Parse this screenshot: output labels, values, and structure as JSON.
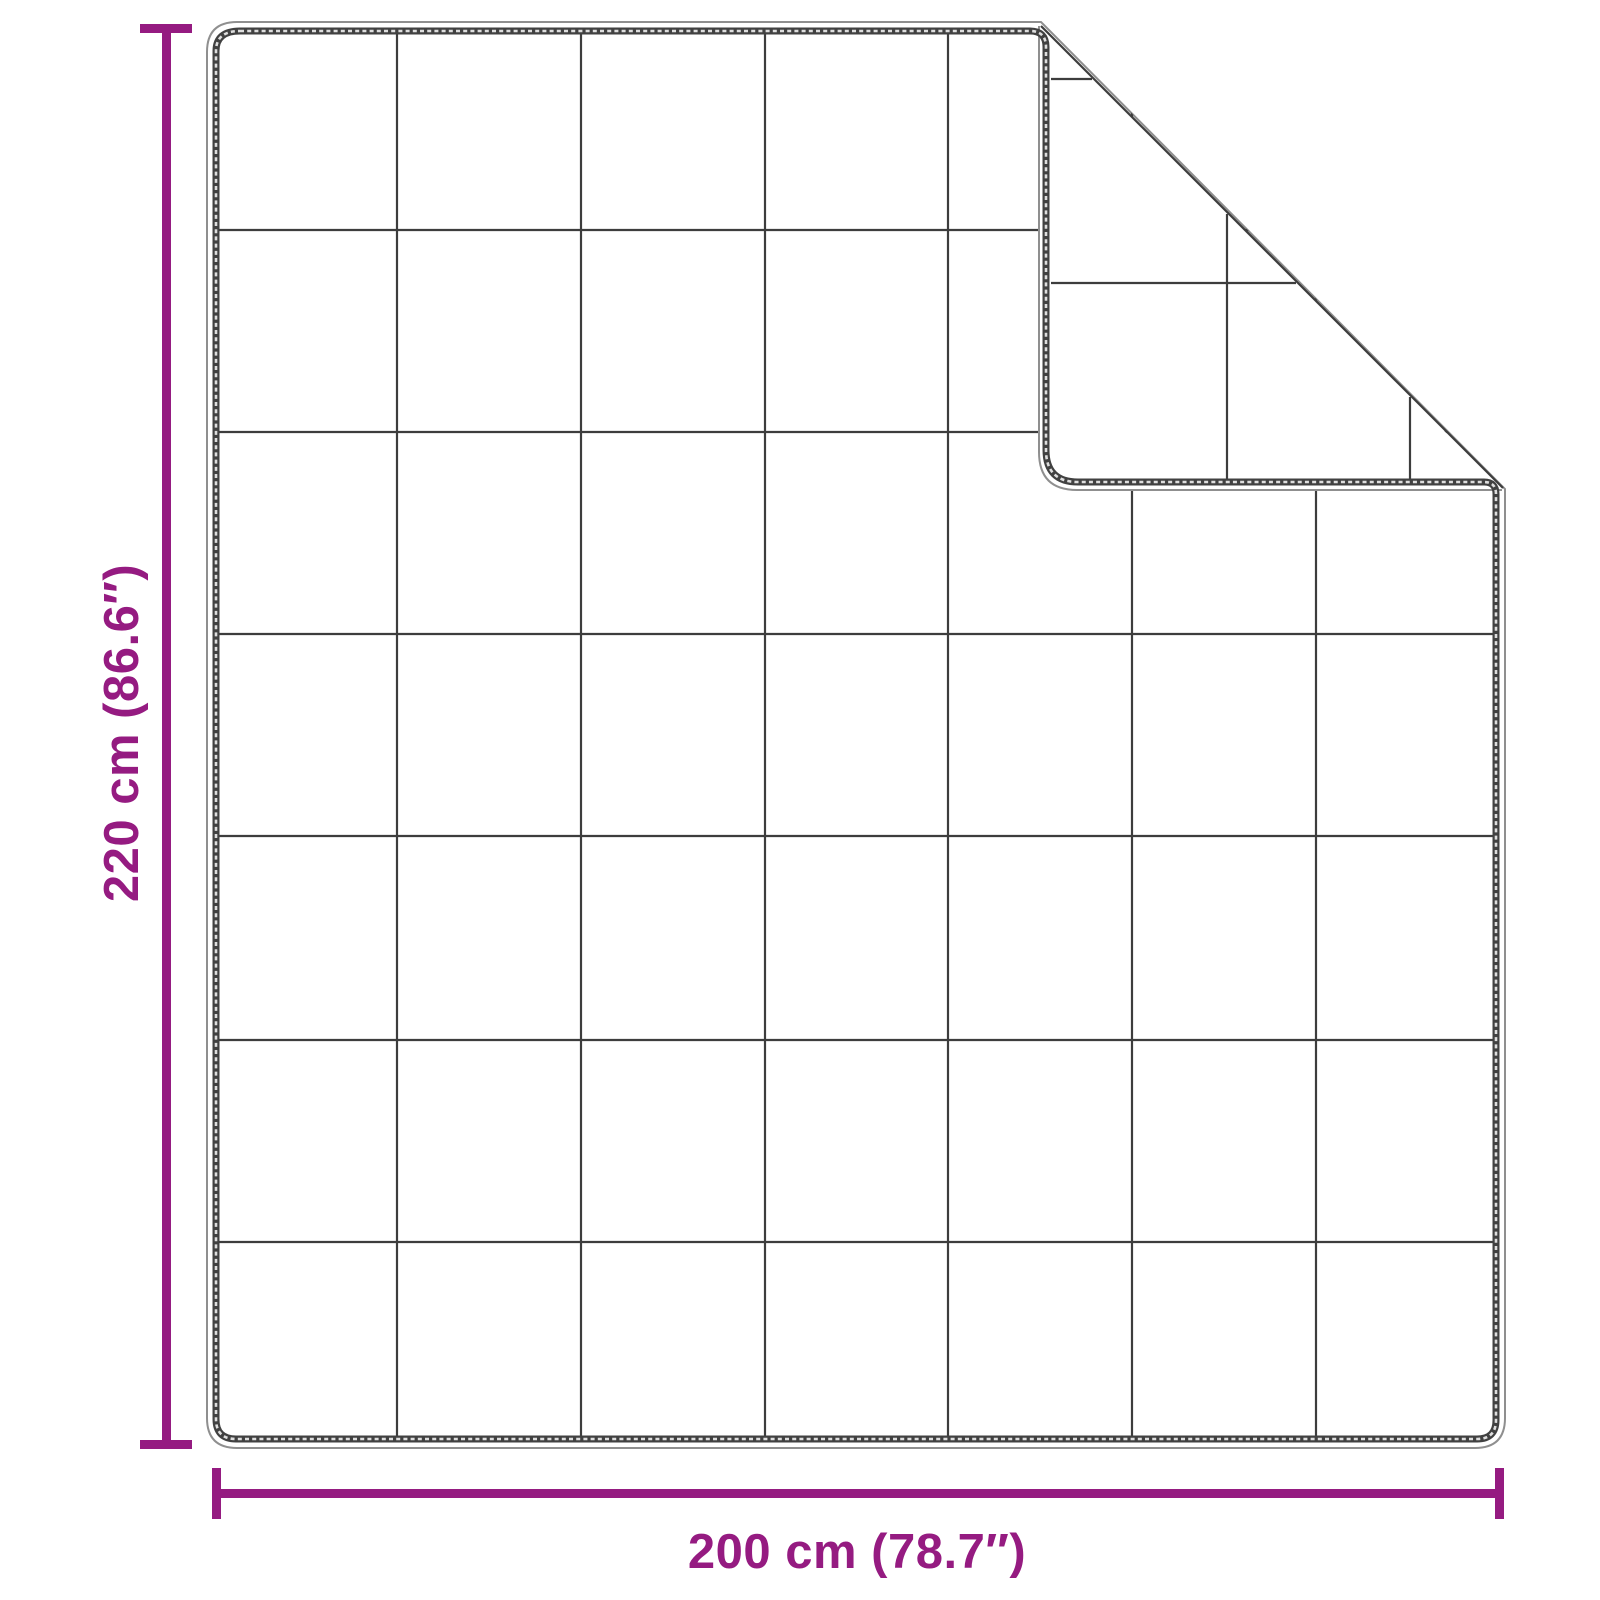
{
  "figure": {
    "title": "weighted-blanket-dimension-diagram",
    "labels": {
      "height": "220 cm (86.6″)",
      "width": "200 cm (78.7″)"
    },
    "colors": {
      "accent": "#951b81",
      "line": "#3d3d3d",
      "band": "#414141",
      "contour": "#8f8f8f",
      "background": "#ffffff"
    },
    "blanket": {
      "body": {
        "left": 207,
        "top": 22,
        "right": 1505,
        "bottom": 1448,
        "corner_radius": 30
      },
      "grid": {
        "columns": 7,
        "rows": 7,
        "vertical_x": [
          397,
          581,
          765,
          948,
          1132,
          1316
        ],
        "horizontal_y": [
          230,
          432,
          634,
          836,
          1040,
          1242
        ],
        "span": {
          "x1": 217,
          "x2": 1496,
          "y1": 32,
          "y2": 1438
        }
      },
      "fold": {
        "diagonal": {
          "x1": 1041,
          "y1": 26,
          "x2": 1503,
          "y2": 488
        },
        "flap_left_x": 1046,
        "flap_bottom_y": 482,
        "flap_grid_vertical_x": [
          1227,
          1410
        ],
        "flap_grid_horizontal_y": [
          79,
          283
        ],
        "flap_grid_start_x": 1051,
        "flap_grid_end_y": 479
      }
    },
    "dimension_lines": {
      "vertical_value_cm": 220,
      "vertical_value_in": 86.6,
      "horizontal_value_cm": 200,
      "horizontal_value_in": 78.7
    }
  }
}
